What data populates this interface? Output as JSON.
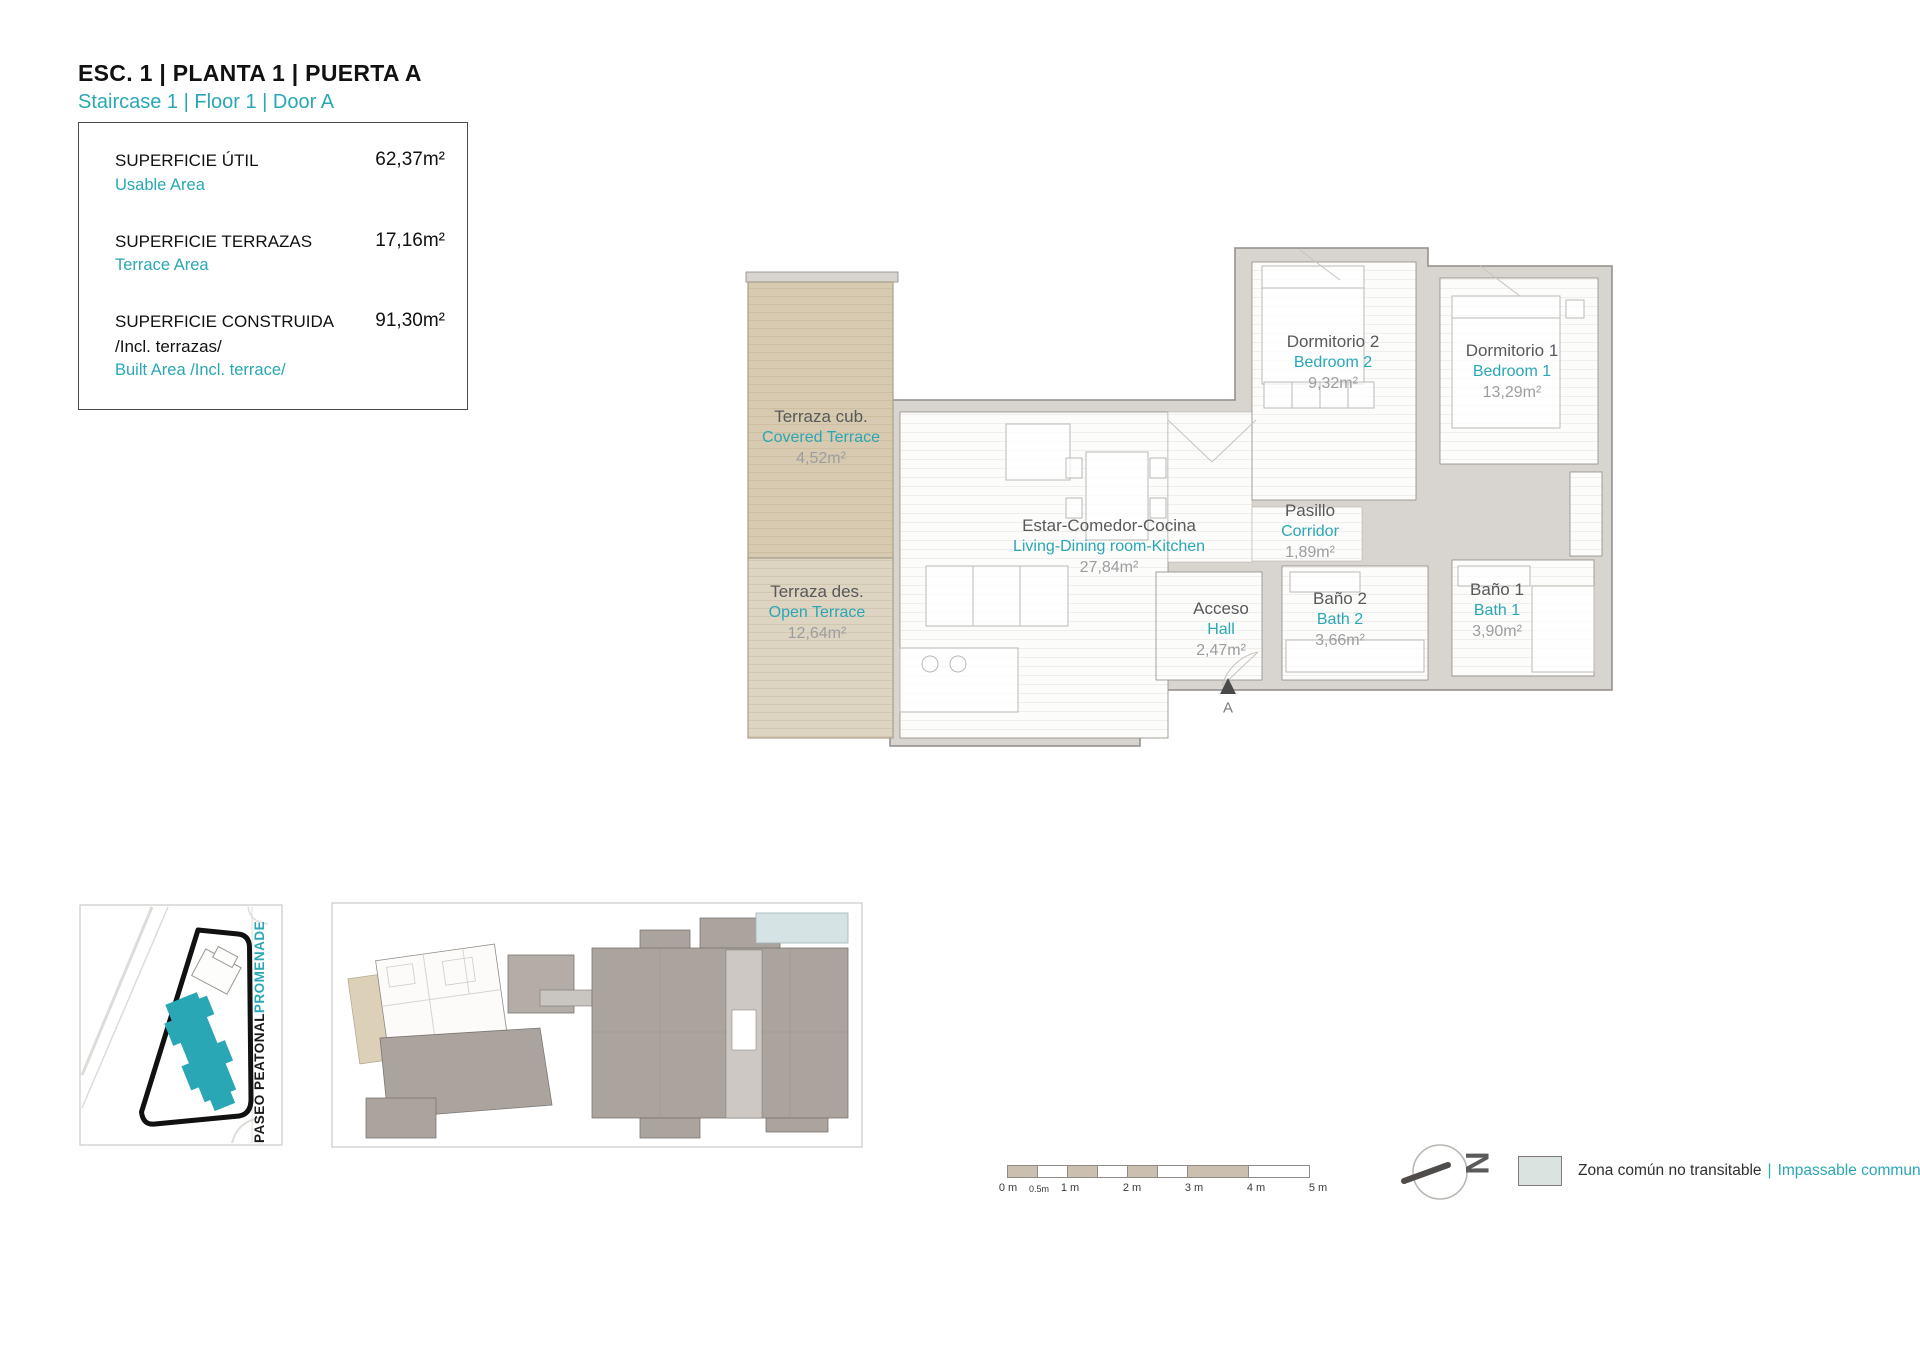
{
  "colors": {
    "accent": "#2AA7B5",
    "terrace_tan": "#D8CCB2",
    "wall_gray": "#D8D4D0",
    "communal_area": "#DBE3E1",
    "scale_tan": "#CBC0AF"
  },
  "header": {
    "title": "ESC. 1 | PLANTA 1 | PUERTA A",
    "subtitle": "Staircase 1 | Floor 1 | Door A"
  },
  "summary": {
    "rows": [
      {
        "label_es": "SUPERFICIE ÚTIL",
        "label_es2": "",
        "label_en": "Usable Area",
        "value": "62,37m²"
      },
      {
        "label_es": "SUPERFICIE TERRAZAS",
        "label_es2": "",
        "label_en": "Terrace Area",
        "value": "17,16m²"
      },
      {
        "label_es": "SUPERFICIE CONSTRUIDA",
        "label_es2": "/Incl. terrazas/",
        "label_en": "Built Area /Incl. terrace/",
        "value": "91,30m²"
      }
    ]
  },
  "plan": {
    "rooms": {
      "covered_terrace": {
        "es": "Terraza cub.",
        "en": "Covered Terrace",
        "area": "4,52m²"
      },
      "open_terrace": {
        "es": "Terraza des.",
        "en": "Open Terrace",
        "area": "12,64m²"
      },
      "living": {
        "es": "Estar-Comedor-Cocina",
        "en": "Living-Dining room-Kitchen",
        "area": "27,84m²"
      },
      "bedroom2": {
        "es": "Dormitorio 2",
        "en": "Bedroom 2",
        "area": "9,32m²"
      },
      "bedroom1": {
        "es": "Dormitorio 1",
        "en": "Bedroom 1",
        "area": "13,29m²"
      },
      "corridor": {
        "es": "Pasillo",
        "en": "Corridor",
        "area": "1,89m²"
      },
      "hall": {
        "es": "Acceso",
        "en": "Hall",
        "area": "2,47m²"
      },
      "bath2": {
        "es": "Baño 2",
        "en": "Bath 2",
        "area": "3,66m²"
      },
      "bath1": {
        "es": "Baño 1",
        "en": "Bath 1",
        "area": "3,90m²"
      }
    },
    "entrance_label": "A"
  },
  "site_plan": {
    "street_es": "PASEO PEATONAL",
    "street_en": "PROMENADE"
  },
  "north": {
    "letter": "N"
  },
  "scale_bar": {
    "labels": [
      "0 m",
      "0.5m",
      "1 m",
      "2 m",
      "3 m",
      "4 m",
      "5 m"
    ]
  },
  "legend": {
    "text_es": "Zona común no transitable",
    "separator": "|",
    "text_en": "Impassable communal area"
  }
}
